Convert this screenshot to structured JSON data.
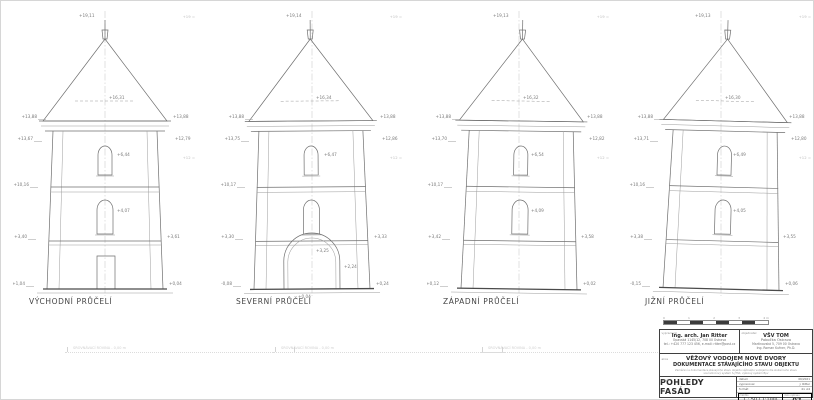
{
  "sheet": {
    "bg": "#ffffff",
    "line_color": "#6f6f6f",
    "annotation_color": "#7a7a7a",
    "faint_color": "#bdbdbd"
  },
  "towers": [
    {
      "label": "VÝCHODNÍ PRŮČELÍ",
      "variant": "door-rect",
      "levels": {
        "top": "+19,11",
        "cone": "+16,31",
        "eaveL": "+13,88",
        "belowEaveL": "+13,67",
        "eaveR": "+13,88",
        "belowEaveR": "+12,79",
        "bandL": "+10,16",
        "winU": "+6,44",
        "winL": "+4,07",
        "lowerL": "+3,40",
        "lowerR": "+3,61",
        "baseL": "+1,04",
        "baseR": "+0,04"
      },
      "datum": [
        "+19 =",
        "+12 ="
      ]
    },
    {
      "label": "SEVERNÍ PRŮČELÍ",
      "variant": "door-arch",
      "levels": {
        "top": "+19,14",
        "cone": "+16,34",
        "eaveL": "+13,88",
        "belowEaveL": "+13,75",
        "eaveR": "+13,88",
        "belowEaveR": "+12,86",
        "bandL": "+10,17",
        "winU": "+6,47",
        "archTop": "+3,25",
        "lowerL": "+3,30",
        "lowerR": "+3,33",
        "doorR": "+2,24",
        "baseL": "-0,08",
        "baseC": "+0,04",
        "baseR": "+0,24"
      },
      "datum": [
        "+19 =",
        "+12 ="
      ]
    },
    {
      "label": "ZÁPADNÍ PRŮČELÍ",
      "variant": "plain",
      "levels": {
        "top": "+19,13",
        "cone": "+16,32",
        "eaveL": "+13,88",
        "belowEaveL": "+13,70",
        "eaveR": "+13,88",
        "belowEaveR": "+12,82",
        "bandL": "+10,17",
        "winU": "+6,54",
        "winL": "+4,09",
        "lowerL": "+3,42",
        "lowerR": "+3,58",
        "baseL": "+0,12",
        "baseR": "+0,02"
      },
      "datum": [
        "+19 =",
        "+12 ="
      ]
    },
    {
      "label": "JIŽNÍ PRŮČELÍ",
      "variant": "plain",
      "levels": {
        "top": "+19,13",
        "cone": "+16,30",
        "eaveL": "+13,88",
        "belowEaveL": "+13,71",
        "eaveR": "+13,88",
        "belowEaveR": "+12,80",
        "bandL": "+10,16",
        "winU": "+6,49",
        "winL": "+4,05",
        "lowerL": "+3,38",
        "lowerR": "+3,55",
        "baseL": "-0,15",
        "baseR": "+0,06"
      },
      "datum": [
        "+19 =",
        "+12 ="
      ]
    }
  ],
  "ground": {
    "items": [
      {
        "text": "SROVNÁVACÍ ROVINA - 0,00 m"
      },
      {
        "text": "SROVNÁVACÍ ROVINA - 0,00 m"
      },
      {
        "text": "SROVNÁVACÍ ROVINA - 0,00 m"
      }
    ]
  },
  "scalebar": {
    "labels": [
      "0",
      "1",
      "2",
      "3",
      "4 m"
    ]
  },
  "titleblock": {
    "architect": {
      "corner_label": "vypracoval",
      "name": "Ing. arch. Jan Ritter",
      "line2": "Opavská 1145/12, 708 00 Ostrava",
      "line3": "tel.: +420 777 123 456, e-mail: ritter@post.cz"
    },
    "client": {
      "corner_label": "objednatel",
      "name": "VŠV TOM",
      "branch": "Pobočka Ostrava",
      "line3": "Martinovská 5, 709 00 Ostrava",
      "line4": "Ing. Roman Kufner, Ph.D."
    },
    "project": {
      "corner_label": "akce",
      "title": "VĚŽOVÝ VODOJEM NOVÉ DVORY",
      "subtitle": "DOKUMENTACE STÁVAJÍCÍHO STAVU OBJEKTU",
      "note1": "Zaměření a dokumentace stávajícího stavu objektu věžového vodojemu dle skutečného stavu",
      "note2": "souřadnicový systém S-JTSK, výškový systém Bpv"
    },
    "content": {
      "corner_label": "obsah",
      "title": "POHLEDY FASÁD"
    },
    "fields": [
      {
        "label": "datum",
        "value": "06/2021"
      },
      {
        "label": "vypracoval",
        "value": "J. Ritter"
      },
      {
        "label": "formát",
        "value": "4× A4"
      }
    ],
    "scale": {
      "label": "měřítko",
      "value": "1 : 50 ( 1:100)"
    },
    "number": {
      "label": "číslo výkresu",
      "value": "02"
    }
  }
}
